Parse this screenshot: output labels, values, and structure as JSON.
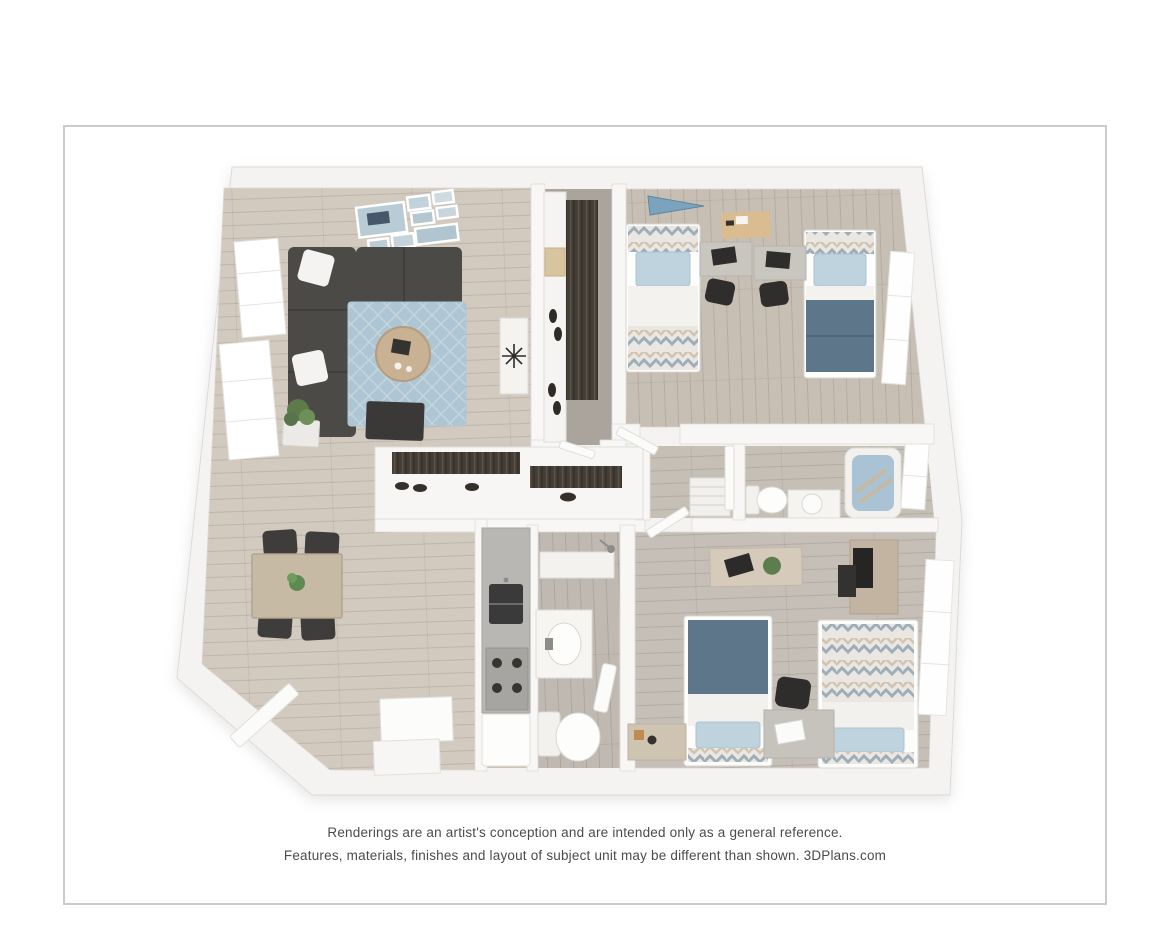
{
  "card": {
    "background": "#ffffff",
    "border_color": "#cccbc9"
  },
  "disclaimer": {
    "line1": "Renderings are an artist's conception and are intended only as a general reference.",
    "line2": "Features, materials, finishes and layout of subject unit may be different than shown. 3DPlans.com"
  },
  "floor_plan": {
    "view": "3d-top-down-rendering",
    "rooms": [
      {
        "name": "living-room",
        "furniture": [
          "sectional-sofa",
          "area-rug",
          "round-coffee-table",
          "media-bench",
          "floor-plant",
          "gallery-wall-frames",
          "console-table",
          "windows"
        ]
      },
      {
        "name": "dining-area",
        "furniture": [
          "dining-table",
          "dining-chairs"
        ]
      },
      {
        "name": "kitchen",
        "furniture": [
          "counter",
          "double-sink",
          "stove",
          "refrigerator",
          "cabinet"
        ]
      },
      {
        "name": "walk-in-closet",
        "furniture": [
          "shelving",
          "hanging-clothes",
          "shoes",
          "storage-box"
        ]
      },
      {
        "name": "bedroom-1",
        "furniture": [
          "twin-bed",
          "twin-bed",
          "desk",
          "desk",
          "office-chair",
          "office-chair",
          "pennant",
          "desk-mat",
          "window"
        ]
      },
      {
        "name": "hall-bathroom",
        "furniture": [
          "bathtub",
          "toilet",
          "vanity-sink",
          "window"
        ]
      },
      {
        "name": "hallway",
        "furniture": [
          "reach-in-closets",
          "linen-shelf",
          "doors"
        ]
      },
      {
        "name": "bathroom-2",
        "furniture": [
          "vanity-sink",
          "toilet",
          "shower",
          "towel",
          "shelf"
        ]
      },
      {
        "name": "bedroom-2",
        "furniture": [
          "twin-bed",
          "twin-bed",
          "desk",
          "office-chair",
          "console-bench",
          "dresser",
          "nightstand",
          "window"
        ]
      },
      {
        "name": "entry",
        "furniture": [
          "entry-door"
        ]
      }
    ],
    "colors": {
      "wall": "#f6f5f3",
      "wall_edge": "#dcdad6",
      "floor_light": "#d2cabf",
      "floor_gray": "#c6bfb5",
      "closet_floor": "#aaa49d",
      "rug": "#aec6d3",
      "sofa": "#4b4a47",
      "blanket_slate": "#5e7689",
      "pillow_blue": "#bfd3de",
      "tub_water": "#a9c3d4",
      "wood_furniture": "#c9b193",
      "dark_furniture": "#3a3937"
    }
  }
}
